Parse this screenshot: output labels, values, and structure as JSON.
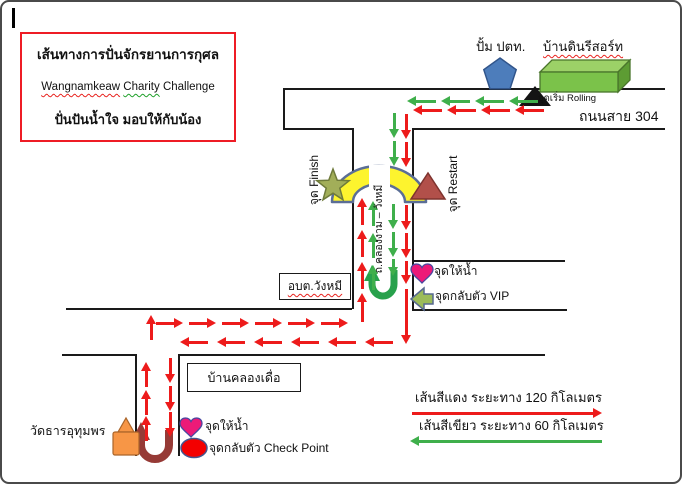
{
  "title": {
    "line1": "เส้นทางการปั่นจักรยานการกุศล",
    "line2_w1": "Wangnamkeaw",
    "line2_w2": "Charity",
    "line2_w3": "Challenge",
    "line3": "ปั่นปันน้ำใจ  มอบให้กับน้อง"
  },
  "landmarks": {
    "gas_station": "ปั้ม ปตท.",
    "resort": "บ้านดินรีสอร์ท",
    "start_point": "จุดเริ่ม Rolling",
    "road_304": "ถนนสาย 304",
    "finish": "จุด Finish",
    "restart": "จุด Restart",
    "vertical_road": "ถ.คลองงาม – วังหมี",
    "water_point_1": "จุดให้น้ำ",
    "vip_turnaround": "จุดกลับตัว VIP",
    "sao_wangmi": "อบต.วังหมี",
    "village": "บ้านคลองเดื่อ",
    "temple": "วัดธารอุทุมพร",
    "water_point_2": "จุดให้น้ำ",
    "checkpoint_turnaround": "จุดกลับตัว Check Point"
  },
  "legend": {
    "red_line": "เส้นสีแดง  ระยะทาง  120  กิโลเมตร",
    "green_line": "เส้นสีเขียว  ระยะทาง  60  กิโลเมตร"
  },
  "colors": {
    "route_red": "#ed1b1b",
    "route_green": "#3faf4b",
    "road": "#1a1a1a",
    "title_border": "#ee1c25",
    "bridge_yellow": "#fdf42e",
    "heart_pink": "#ec1a78",
    "restart_brick": "#b2504a",
    "pentagon_blue": "#4d7dbb",
    "resort_green": "#7bc24a",
    "temple_orange": "#f79646",
    "vip_olive": "#9bbb59"
  },
  "icons": [
    "gas-station-pentagon-icon",
    "resort-building-icon",
    "start-rolling-triangle-icon",
    "bridge-arc",
    "finish-star-icon",
    "restart-triangle-icon",
    "water-heart-icon",
    "vip-turn-arrow-icon",
    "green-uturn-arrow-icon",
    "red-uturn-arrow-icon",
    "checkpoint-ellipse-icon",
    "temple-icon"
  ],
  "roads": [
    [
      281,
      86,
      382,
      0
    ],
    [
      281,
      86,
      0,
      40
    ],
    [
      281,
      126,
      69,
      0
    ],
    [
      410,
      126,
      253,
      0
    ],
    [
      350,
      126,
      0,
      181
    ],
    [
      410,
      126,
      0,
      182
    ],
    [
      410,
      258,
      153,
      0
    ],
    [
      64,
      306,
      286,
      0
    ],
    [
      410,
      307,
      155,
      0
    ],
    [
      60,
      352,
      73,
      0
    ],
    [
      176,
      352,
      367,
      0
    ],
    [
      133,
      352,
      0,
      102
    ],
    [
      176,
      352,
      0,
      102
    ]
  ],
  "arrows": [
    {
      "d": "l",
      "c": "g",
      "x": 405,
      "y": 94,
      "len": 29
    },
    {
      "d": "l",
      "c": "g",
      "x": 439,
      "y": 94,
      "len": 29
    },
    {
      "d": "l",
      "c": "g",
      "x": 473,
      "y": 94,
      "len": 29
    },
    {
      "d": "l",
      "c": "g",
      "x": 507,
      "y": 94,
      "len": 29
    },
    {
      "d": "l",
      "c": "r",
      "x": 411,
      "y": 103,
      "len": 29
    },
    {
      "d": "l",
      "c": "r",
      "x": 445,
      "y": 103,
      "len": 29
    },
    {
      "d": "l",
      "c": "r",
      "x": 479,
      "y": 103,
      "len": 29
    },
    {
      "d": "l",
      "c": "r",
      "x": 513,
      "y": 103,
      "len": 29
    },
    {
      "d": "d",
      "c": "g",
      "x": 387,
      "y": 111,
      "len": 25
    },
    {
      "d": "d",
      "c": "r",
      "x": 399,
      "y": 112,
      "len": 25
    },
    {
      "d": "d",
      "c": "g",
      "x": 387,
      "y": 139,
      "len": 25
    },
    {
      "d": "d",
      "c": "r",
      "x": 399,
      "y": 140,
      "len": 25
    },
    {
      "d": "d",
      "c": "g",
      "x": 386,
      "y": 202,
      "len": 25
    },
    {
      "d": "d",
      "c": "r",
      "x": 399,
      "y": 203,
      "len": 25
    },
    {
      "d": "d",
      "c": "g",
      "x": 386,
      "y": 230,
      "len": 25
    },
    {
      "d": "d",
      "c": "r",
      "x": 399,
      "y": 231,
      "len": 25
    },
    {
      "d": "d",
      "c": "g",
      "x": 386,
      "y": 257,
      "len": 17
    },
    {
      "d": "d",
      "c": "r",
      "x": 399,
      "y": 259,
      "len": 23
    },
    {
      "d": "d",
      "c": "r",
      "x": 399,
      "y": 287,
      "len": 55
    },
    {
      "d": "u",
      "c": "r",
      "x": 355,
      "y": 196,
      "len": 27
    },
    {
      "d": "u",
      "c": "g",
      "x": 366,
      "y": 199,
      "len": 25
    },
    {
      "d": "u",
      "c": "r",
      "x": 355,
      "y": 228,
      "len": 27
    },
    {
      "d": "u",
      "c": "g",
      "x": 366,
      "y": 231,
      "len": 25
    },
    {
      "d": "u",
      "c": "r",
      "x": 355,
      "y": 260,
      "len": 27
    },
    {
      "d": "u",
      "c": "g",
      "x": 366,
      "y": 263,
      "len": 25
    },
    {
      "d": "u",
      "c": "r",
      "x": 355,
      "y": 291,
      "len": 29
    },
    {
      "d": "u",
      "c": "r",
      "x": 144,
      "y": 313,
      "len": 25
    },
    {
      "d": "r",
      "c": "r",
      "x": 154,
      "y": 316,
      "len": 27
    },
    {
      "d": "r",
      "c": "r",
      "x": 187,
      "y": 316,
      "len": 27
    },
    {
      "d": "r",
      "c": "r",
      "x": 220,
      "y": 316,
      "len": 27
    },
    {
      "d": "r",
      "c": "r",
      "x": 253,
      "y": 316,
      "len": 27
    },
    {
      "d": "r",
      "c": "r",
      "x": 286,
      "y": 316,
      "len": 27
    },
    {
      "d": "r",
      "c": "r",
      "x": 319,
      "y": 316,
      "len": 27
    },
    {
      "d": "l",
      "c": "r",
      "x": 178,
      "y": 335,
      "len": 28
    },
    {
      "d": "l",
      "c": "r",
      "x": 215,
      "y": 335,
      "len": 28
    },
    {
      "d": "l",
      "c": "r",
      "x": 252,
      "y": 335,
      "len": 28
    },
    {
      "d": "l",
      "c": "r",
      "x": 289,
      "y": 335,
      "len": 28
    },
    {
      "d": "l",
      "c": "r",
      "x": 326,
      "y": 335,
      "len": 28
    },
    {
      "d": "l",
      "c": "r",
      "x": 363,
      "y": 335,
      "len": 28
    },
    {
      "d": "u",
      "c": "r",
      "x": 139,
      "y": 360,
      "len": 25
    },
    {
      "d": "u",
      "c": "r",
      "x": 139,
      "y": 388,
      "len": 25
    },
    {
      "d": "u",
      "c": "r",
      "x": 139,
      "y": 414,
      "len": 25
    },
    {
      "d": "d",
      "c": "r",
      "x": 163,
      "y": 356,
      "len": 25
    },
    {
      "d": "d",
      "c": "r",
      "x": 163,
      "y": 384,
      "len": 25
    },
    {
      "d": "d",
      "c": "r",
      "x": 163,
      "y": 410,
      "len": 25
    },
    {
      "d": "r",
      "c": "r",
      "x": 410,
      "y": 406,
      "len": 190
    },
    {
      "d": "l",
      "c": "g",
      "x": 408,
      "y": 434,
      "len": 192
    }
  ]
}
